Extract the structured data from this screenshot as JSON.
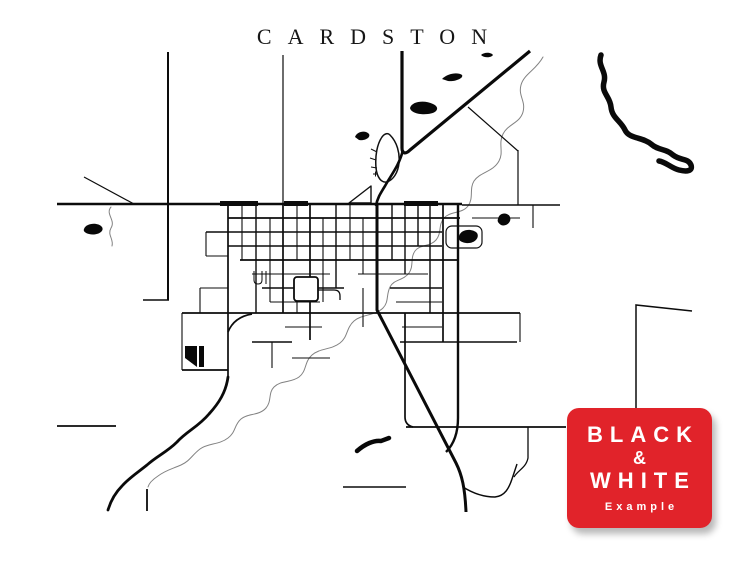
{
  "map": {
    "title": "CARDSTON",
    "style": "black-and-white-street-map",
    "background_color": "#ffffff",
    "ink_color": "#0c0c0c",
    "creek_line_color": "#828282"
  },
  "badge": {
    "line1": "BLACK",
    "line2": "&",
    "line3": "WHITE",
    "caption": "Example",
    "background_color": "#e1232a",
    "text_color": "#ffffff"
  }
}
